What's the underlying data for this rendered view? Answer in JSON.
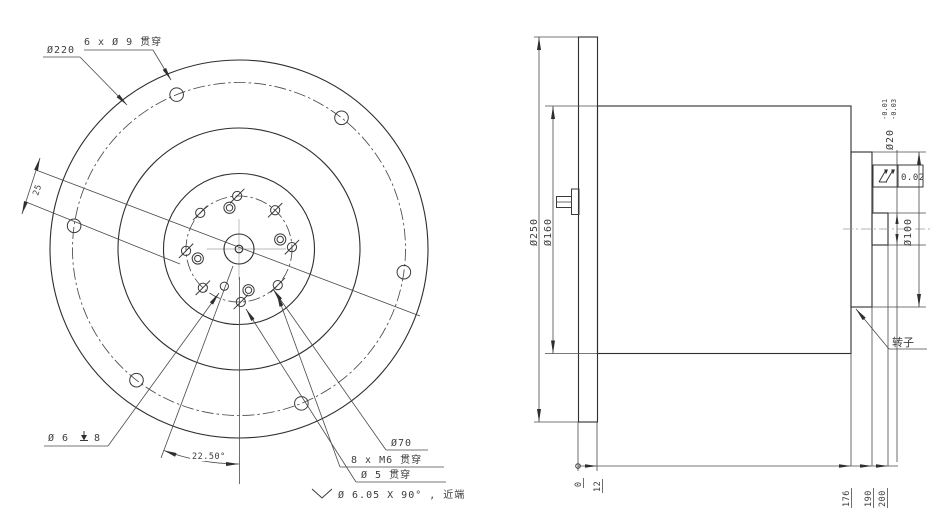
{
  "front": {
    "labels": {
      "bolt_pattern": "6 x Ø 9 贯穿",
      "bcd_outer": "Ø220",
      "offset_dim": "25",
      "blind_hole_prefix": "Ø 6",
      "blind_hole_depth": "8",
      "angle_dim": "22.50°",
      "hub_bcd": "Ø70",
      "tapped_holes": "8 x M6 贯穿",
      "center_hole": "Ø 5 贯穿",
      "countersink": "Ø 6.05 X 90° , 近端"
    },
    "geometry": {
      "center": {
        "x": 239,
        "y": 249
      },
      "circles": [
        {
          "r": 189,
          "style": "solid",
          "name": "flange-od-circle"
        },
        {
          "r": 166.5,
          "style": "dashdot",
          "name": "bolt-circle-220"
        },
        {
          "r": 121,
          "style": "solid",
          "name": "body-od-circle"
        },
        {
          "r": 75.5,
          "style": "solid",
          "name": "rotor-od-circle"
        },
        {
          "r": 53,
          "style": "dashdot",
          "name": "bolt-circle-70"
        },
        {
          "r": 15,
          "style": "solid",
          "name": "shaft-circle"
        },
        {
          "r": 3.8,
          "style": "solid",
          "name": "center-hole-circle"
        }
      ],
      "hole_patterns": [
        {
          "name": "through-hole-9",
          "style": "plain",
          "count": 6,
          "pattern_r": 166.5,
          "hole_r": 6.8,
          "start": 8,
          "step": 60
        },
        {
          "name": "tapped-hole-m6",
          "style": "slash",
          "count": 8,
          "pattern_r": 53,
          "hole_r": 4.6,
          "start": -2,
          "step": 45
        },
        {
          "name": "counterbore-hole-6",
          "style": "double",
          "count": 4,
          "pattern_r": 42.3,
          "hole_r": 5.6,
          "inner_r": 3.2,
          "start": -13,
          "step": 90
        },
        {
          "name": "pin-hole-5",
          "style": "plain",
          "count": 1,
          "pattern_r": 40,
          "hole_r": 4.1,
          "start": 111.5,
          "step": 0
        }
      ]
    }
  },
  "side": {
    "labels": {
      "flange_od": "Ø250",
      "body_od": "Ø160",
      "rotor_od": "Ø100",
      "shaft_d": "Ø20",
      "shaft_tol_upper": "-0.01",
      "shaft_tol_lower": "-0.03",
      "runout_tol": "0.02",
      "rotor": "转子"
    },
    "ordinates": [
      "0",
      "12",
      "176",
      "190",
      "200"
    ]
  }
}
